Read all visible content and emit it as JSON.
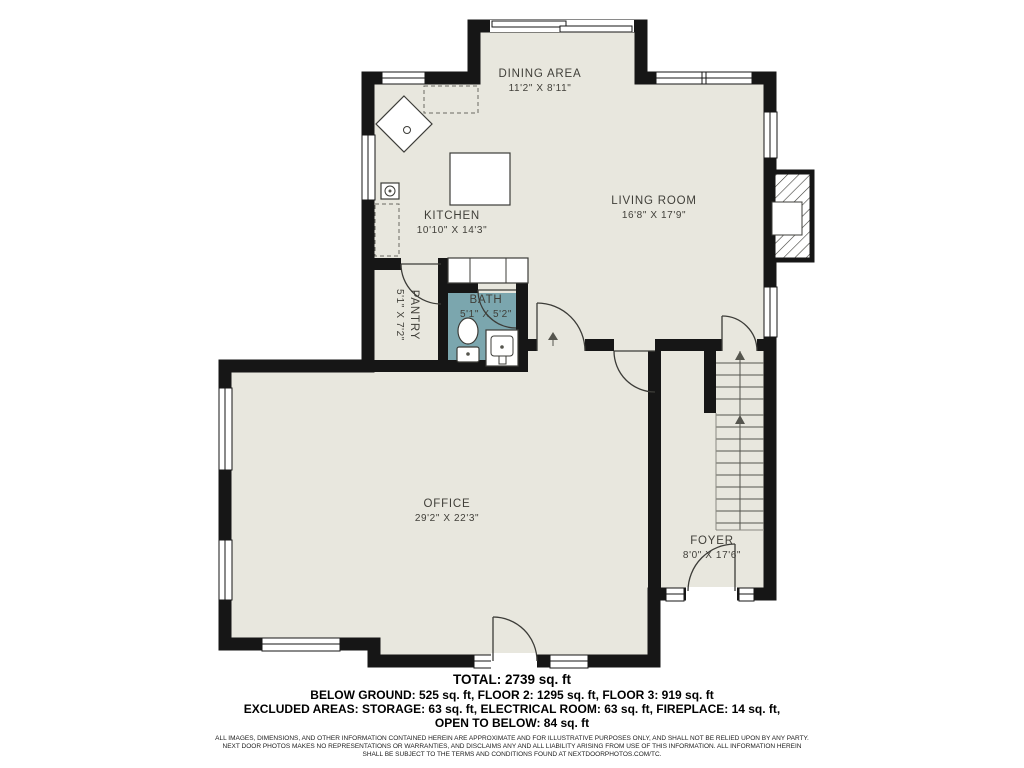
{
  "rooms": [
    {
      "id": "dining",
      "name": "DINING AREA",
      "dims": "11'2\" X 8'11\""
    },
    {
      "id": "living",
      "name": "LIVING ROOM",
      "dims": "16'8\" X 17'9\""
    },
    {
      "id": "kitchen",
      "name": "KITCHEN",
      "dims": "10'10\" X 14'3\""
    },
    {
      "id": "pantry",
      "name": "PANTRY",
      "dims": "5'1\" X 7'2\""
    },
    {
      "id": "bath",
      "name": "BATH",
      "dims": "5'1\" X 5'2\""
    },
    {
      "id": "office",
      "name": "OFFICE",
      "dims": "29'2\" X 22'3\""
    },
    {
      "id": "foyer",
      "name": "FOYER",
      "dims": "8'0\" X 17'6\""
    }
  ],
  "summary": {
    "total": "TOTAL: 2739 sq. ft",
    "floors": "BELOW GROUND: 525 sq. ft, FLOOR 2: 1295 sq. ft, FLOOR 3: 919 sq. ft",
    "excluded": "EXCLUDED AREAS: STORAGE: 63 sq. ft, ELECTRICAL ROOM: 63 sq. ft, FIREPLACE: 14 sq. ft,",
    "open_below": "OPEN TO BELOW: 84 sq. ft"
  },
  "disclaimer": {
    "line1": "ALL IMAGES, DIMENSIONS, AND OTHER INFORMATION CONTAINED HEREIN ARE APPROXIMATE AND FOR ILLUSTRATIVE PURPOSES ONLY, AND SHALL NOT BE RELIED UPON BY ANY PARTY.",
    "line2": "NEXT DOOR PHOTOS MAKES NO REPRESENTATIONS OR WARRANTIES, AND DISCLAIMS ANY AND ALL LIABILITY ARISING FROM USE OF THIS INFORMATION. ALL INFORMATION HEREIN",
    "line3": "SHALL BE SUBJECT TO THE TERMS AND CONDITIONS FOUND AT NEXTDOORPHOTOS.COM/TC."
  },
  "colors": {
    "floor": "#e8e7de",
    "wall": "#161616",
    "bath": "#7ba6ae",
    "label": "#403f39"
  }
}
